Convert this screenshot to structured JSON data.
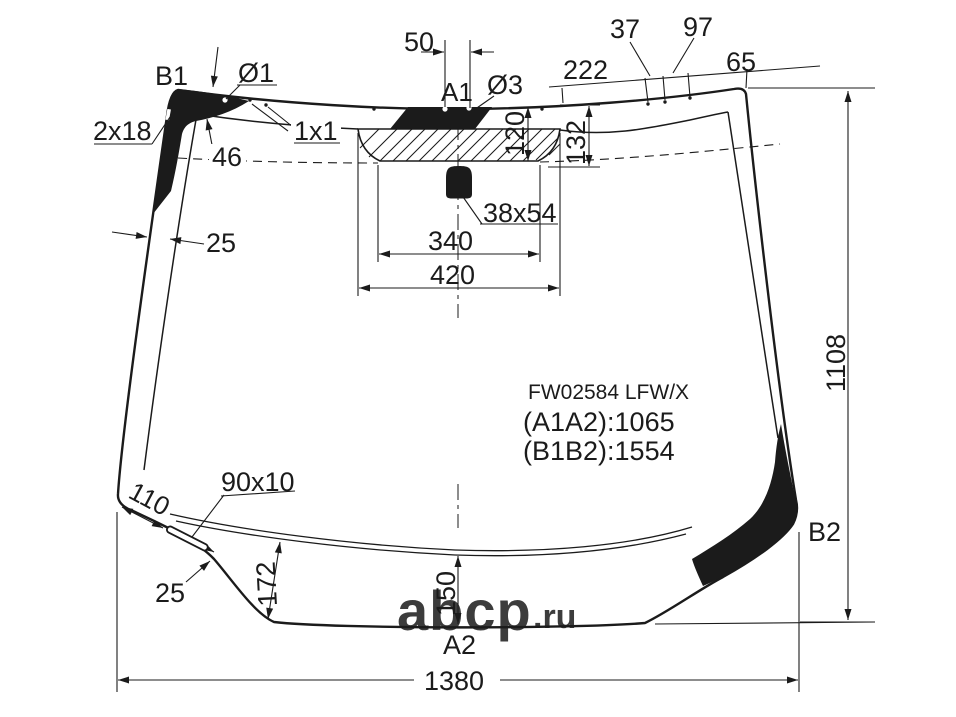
{
  "colors": {
    "ink": "#1b1b1b",
    "watermark": "#c1c1c1",
    "background": "#ffffff"
  },
  "part_info": {
    "code": "FW02584 LFW/X",
    "diagonal_a": "(A1A2):1065",
    "diagonal_b": "(B1B2):1554"
  },
  "corner_labels": {
    "b1": "B1",
    "b2": "B2",
    "a1": "A1",
    "a2": "A2"
  },
  "dimensions": {
    "hole_spacing_50": "50",
    "edge_seg_37": "37",
    "edge_seg_97": "97",
    "edge_seg_222": "222",
    "edge_seg_65": "65",
    "hole_dia_1": "Ø1",
    "hole_dia_3": "Ø3",
    "notch_2x18": "2x18",
    "dot_1x1": "1x1",
    "band_46": "46",
    "band_25_top": "25",
    "sensor_depth_120": "120",
    "sensor_depth_132": "132",
    "mount_38x54": "38x54",
    "sensor_width_340": "340",
    "sensor_width_420": "420",
    "height_1108": "1108",
    "corner_110": "110",
    "slot_90x10": "90x10",
    "band_25_bottom": "25",
    "band_172": "172",
    "band_150": "150",
    "width_1380": "1380"
  },
  "watermark": {
    "name": "abcp",
    "tld": ".ru"
  }
}
